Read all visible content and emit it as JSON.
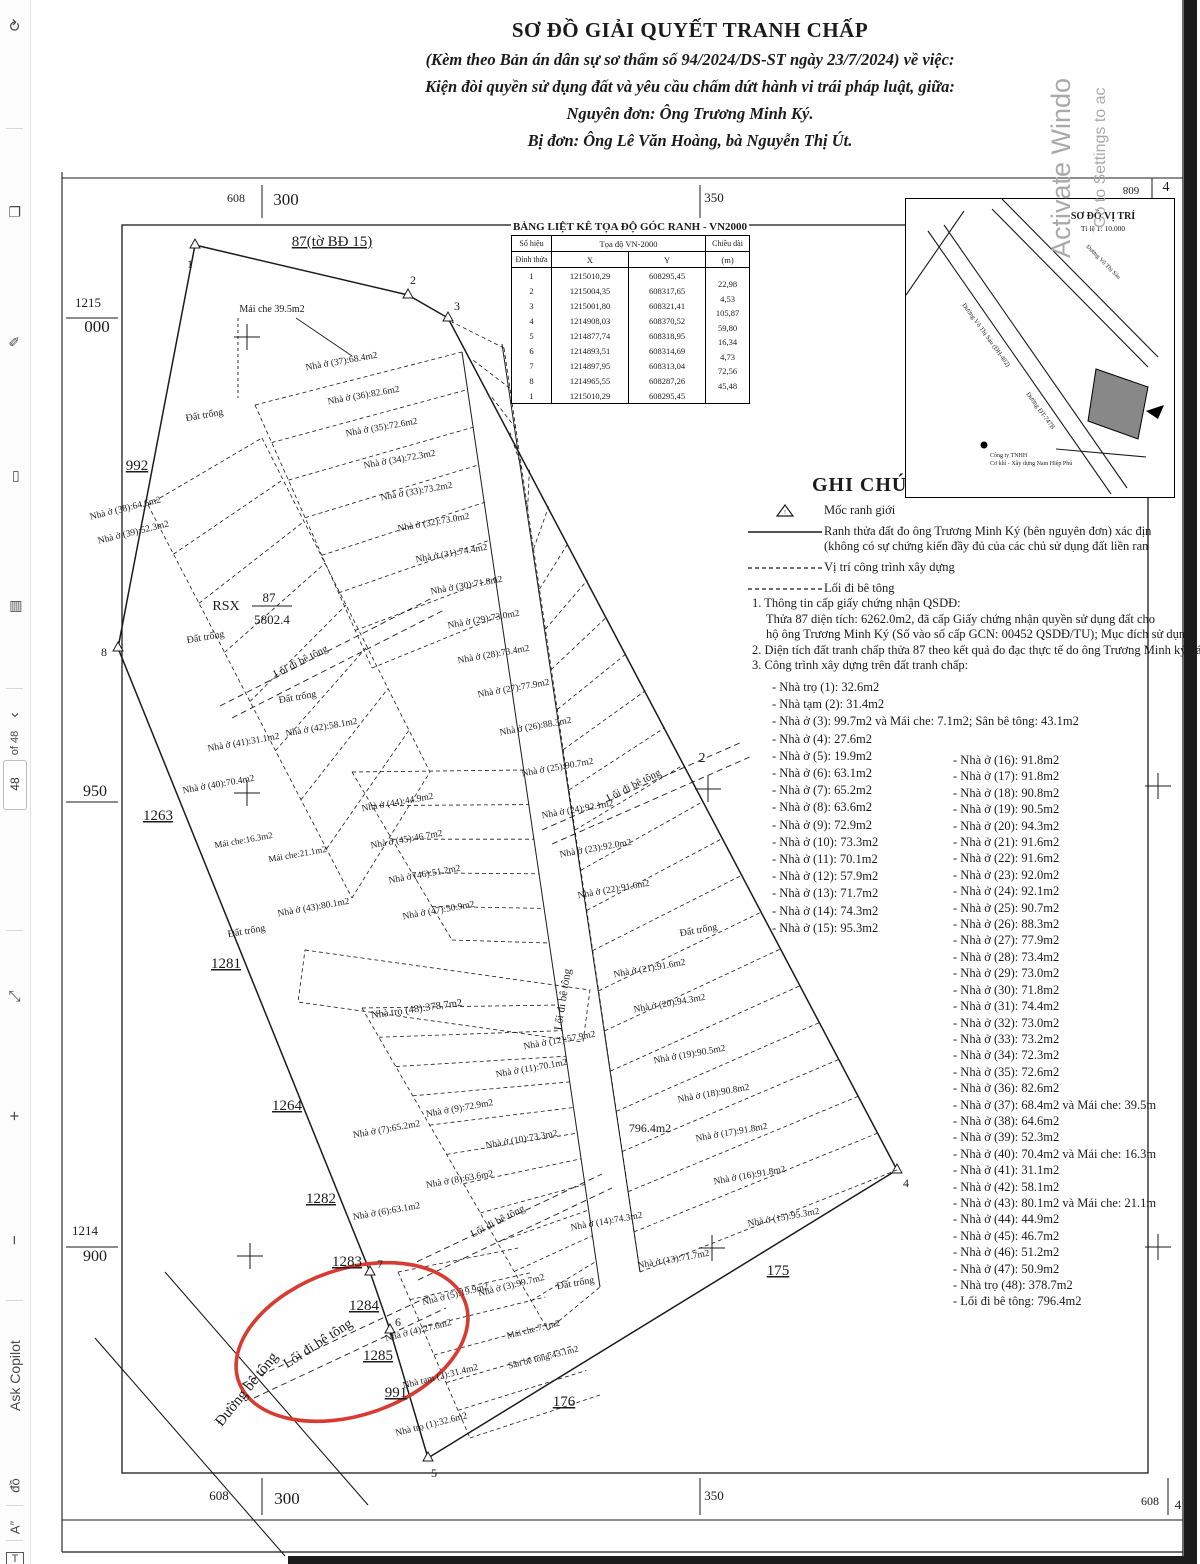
{
  "colors": {
    "ink": "#1b1b1b",
    "red_annotation": "#d93a32",
    "watermark_gray": "#a9a9a9",
    "scan_band": "#1c1c1c"
  },
  "sidebar": {
    "items": [
      {
        "name": "rotate-icon",
        "glyph": "⟳",
        "y": 16,
        "size": 15
      },
      {
        "name": "pages-icon",
        "glyph": "❏",
        "y": 203,
        "size": 14
      },
      {
        "name": "pen-icon",
        "glyph": "✎",
        "y": 333,
        "size": 14
      },
      {
        "name": "highlight-icon",
        "glyph": "▭",
        "y": 468,
        "size": 14
      },
      {
        "name": "print-icon",
        "glyph": "▤",
        "y": 598,
        "size": 14
      },
      {
        "name": "chevron-icon",
        "glyph": "‹",
        "y": 706,
        "size": 16
      },
      {
        "name": "page-count-label",
        "glyph": "of 48",
        "y": 737,
        "size": 11
      },
      {
        "name": "fit-page-icon",
        "glyph": "⤢",
        "y": 988,
        "size": 15
      },
      {
        "name": "zoom-in-icon",
        "glyph": "+",
        "y": 1106,
        "size": 17
      },
      {
        "name": "zoom-out-icon",
        "glyph": "−",
        "y": 1230,
        "size": 17
      },
      {
        "name": "ask-copilot-button",
        "glyph": "Ask Copilot",
        "y": 1388,
        "size": 14
      },
      {
        "name": "translate-icon",
        "glyph": "đồ",
        "y": 1478,
        "size": 13
      },
      {
        "name": "read-aloud-icon",
        "glyph": "A″",
        "y": 1520,
        "size": 13
      },
      {
        "name": "text-box-icon",
        "glyph": "T",
        "y": 1552,
        "size": 11,
        "boxed": true
      }
    ],
    "dividers_y": [
      128,
      688,
      930,
      1300,
      1505,
      1540
    ],
    "page_number": "48"
  },
  "watermark": {
    "line1": "Activate Windo",
    "line2": "Go to Settings to ac"
  },
  "title": {
    "main": "SƠ ĐỒ GIẢI QUYẾT TRANH CHẤP",
    "sub1": "(Kèm theo Bản án dân sự sơ thẩm số 94/2024/DS-ST ngày 23/7/2024) về việc:",
    "sub2": "Kiện đòi quyền sử dụng đất và yêu cầu chấm dứt hành vi trái pháp luật, giữa:",
    "sub3": "Nguyên đơn: Ông Trương Minh Ký.",
    "sub4": "Bị đơn: Ông Lê Văn Hoàng, bà Nguyễn Thị Út."
  },
  "coord_table": {
    "title": "BẢNG LIỆT KÊ TỌA ĐỘ GÓC RANH - VN2000",
    "col1a": "Số hiệu",
    "col1b": "Đỉnh thửa",
    "col2": "Tọa độ VN-2000",
    "colx": "X",
    "coly": "Y",
    "col3a": "Chiều dài",
    "col3b": "(m)",
    "rows": [
      {
        "id": "1",
        "x": "1215010,29",
        "y": "608295,45"
      },
      {
        "id": "2",
        "x": "1215004,35",
        "y": "608317,65"
      },
      {
        "id": "3",
        "x": "1215001,80",
        "y": "608321,41"
      },
      {
        "id": "4",
        "x": "1214908,03",
        "y": "608370,52"
      },
      {
        "id": "5",
        "x": "1214877,74",
        "y": "608318,95"
      },
      {
        "id": "6",
        "x": "1214893,51",
        "y": "608314,69"
      },
      {
        "id": "7",
        "x": "1214897,95",
        "y": "608313,04"
      },
      {
        "id": "8",
        "x": "1214965,55",
        "y": "608287,26"
      },
      {
        "id": "1",
        "x": "1215010,29",
        "y": "608295,45"
      }
    ],
    "lengths": [
      "22,98",
      "4,53",
      "105,87",
      "59,80",
      "16,34",
      "4,73",
      "72,56",
      "45,48"
    ]
  },
  "inset": {
    "title": "SƠ ĐỒ VỊ TRÍ",
    "scale": "Tỉ lệ 1: 10.000",
    "road1": "Đường Võ Thị Sáu (ĐH-402)",
    "road2": "Đường ĐT-747B",
    "road3": "Đường Võ Thị Sáu",
    "poi1": "Công ty TNHH",
    "poi2": "Cơ khí - Xây dựng Nam Hiệp Phú"
  },
  "legend": {
    "heading": "GHI CHÚ",
    "items": [
      {
        "symbol": "triangle",
        "lines": [
          "Mốc ranh giới"
        ]
      },
      {
        "symbol": "solid",
        "lines": [
          "Ranh thửa đất đo ông Trương Minh Ký (bên nguyên đơn) xác địn",
          "(không có sự chứng kiến đầy đủ của các chủ sử dụng đất liền ran"
        ]
      },
      {
        "symbol": "dashed",
        "lines": [
          "Vị trí công trình xây dựng"
        ]
      },
      {
        "symbol": "dashed",
        "lines": [
          "Lối đi bê tông"
        ]
      }
    ]
  },
  "notes": {
    "n1": "1. Thông tin cấp giấy chứng nhận QSDĐ:",
    "n1b": "Thửa 87 diện tích: 6262.0m2, đã cấp Giấy chứng nhận quyền sử dụng đất cho",
    "n1c": "hộ ông Trương Minh Ký (Số vào số cấp GCN: 00452 QSDĐ/TU); Mục đích sử dụn",
    "n2": "2. Diện tích đất tranh chấp thửa 87 theo kết quả đo đạc thực tế do ông Trương Minh ký xác định là: 5",
    "n3": "3. Công trình xây dựng trên đất tranh chấp:"
  },
  "structures": {
    "col1": [
      "- Nhà trọ (1): 32.6m2",
      "- Nhà tạm (2): 31.4m2",
      "- Nhà ở (3): 99.7m2 và Mái che: 7.1m2; Sân bê tông: 43.1m2",
      "- Nhà ở (4): 27.6m2",
      "- Nhà ở (5): 19.9m2",
      "- Nhà ở (6): 63.1m2",
      "- Nhà ở (7): 65.2m2",
      "- Nhà ở (8): 63.6m2",
      "- Nhà ở (9): 72.9m2",
      "- Nhà ở (10): 73.3m2",
      "- Nhà ở (11): 70.1m2",
      "- Nhà ở (12): 57.9m2",
      "- Nhà ở (13): 71.7m2",
      "- Nhà ở (14): 74.3m2",
      "- Nhà ở (15): 95.3m2"
    ],
    "col2": [
      "- Nhà ở (16): 91.8m2",
      "- Nhà ở (17): 91.8m2",
      "- Nhà ở (18): 90.8m2",
      "- Nhà ở (19): 90.5m2",
      "- Nhà ở (20): 94.3m2",
      "- Nhà ở (21): 91.6m2",
      "- Nhà ở (22): 91.6m2",
      "- Nhà ở (23): 92.0m2",
      "- Nhà ở (24): 92.1m2",
      "- Nhà ở (25): 90.7m2",
      "- Nhà ở (26): 88.3m2",
      "- Nhà ở (27): 77.9m2",
      "- Nhà ở (28): 73.4m2",
      "- Nhà ở (29): 73.0m2",
      "- Nhà ở (30): 71.8m2",
      "- Nhà ở (31): 74.4m2",
      "- Nhà ở (32): 73.0m2",
      "- Nhà ở (33): 73.2m2",
      "- Nhà ở (34): 72.3m2",
      "- Nhà ở (35): 72.6m2",
      "- Nhà ở (36): 82.6m2",
      "- Nhà ở (37): 68.4m2 và Mái che: 39.5m",
      "- Nhà ở (38): 64.6m2",
      "- Nhà ở (39): 52.3m2",
      "- Nhà ở (40): 70.4m2 và Mái che: 16.3m",
      "- Nhà ở (41): 31.1m2",
      "- Nhà ở (42): 58.1m2",
      "- Nhà ở (43): 80.1m2 và Mái che: 21.1m",
      "- Nhà ở (44): 44.9m2",
      "- Nhà ở (45): 46.7m2",
      "- Nhà ở (46): 51.2m2",
      "- Nhà ở (47): 50.9m2",
      "- Nhà trọ (48): 378.7m2",
      "- Lối đi bê tông: 796.4m2"
    ]
  },
  "map": {
    "grid_labels": [
      [
        "608",
        236,
        202,
        12,
        0
      ],
      [
        "300",
        286,
        205,
        17,
        0
      ],
      [
        "350",
        714,
        202,
        13,
        0
      ],
      [
        "608",
        1131,
        187,
        11,
        180
      ],
      [
        "4",
        1166,
        191,
        14,
        0
      ],
      [
        "1215",
        88,
        307,
        13,
        0
      ],
      [
        "000",
        97,
        332,
        17,
        0
      ],
      [
        "950",
        95,
        796,
        16,
        0
      ],
      [
        "1214",
        85,
        1235,
        13,
        0
      ],
      [
        "900",
        95,
        1261,
        16,
        0
      ],
      [
        "608",
        219,
        1500,
        13,
        0
      ],
      [
        "300",
        287,
        1504,
        17,
        0
      ],
      [
        "350",
        714,
        1500,
        13,
        0
      ],
      [
        "608",
        1150,
        1505,
        12,
        0
      ],
      [
        "4",
        1178,
        1509,
        13,
        0
      ]
    ],
    "labels": [
      [
        "87(tờ BĐ 15)",
        332,
        246,
        0,
        15,
        1
      ],
      [
        "RSX",
        226,
        610,
        0,
        14,
        0
      ],
      [
        "87",
        269,
        602,
        0,
        13,
        0
      ],
      [
        "5802.4",
        272,
        624,
        0,
        13,
        0
      ],
      [
        "992",
        137,
        470,
        0,
        15,
        1
      ],
      [
        "1263",
        158,
        820,
        0,
        15,
        1
      ],
      [
        "1281",
        226,
        968,
        0,
        15,
        1
      ],
      [
        "1264",
        287,
        1110,
        0,
        15,
        1
      ],
      [
        "1282",
        321,
        1203,
        0,
        15,
        1
      ],
      [
        "1283",
        347,
        1266,
        0,
        15,
        1
      ],
      [
        "1284",
        364,
        1310,
        0,
        15,
        1
      ],
      [
        "1285",
        378,
        1360,
        0,
        15,
        1
      ],
      [
        "991",
        396,
        1397,
        0,
        15,
        1
      ],
      [
        "176",
        564,
        1406,
        0,
        15,
        1
      ],
      [
        "175",
        778,
        1275,
        0,
        15,
        1
      ],
      [
        "2",
        702,
        762,
        0,
        14,
        0
      ],
      [
        "1",
        190,
        268,
        0,
        12,
        0
      ],
      [
        "2",
        413,
        284,
        0,
        12,
        0
      ],
      [
        "3",
        457,
        310,
        0,
        12,
        0
      ],
      [
        "4",
        906,
        1187,
        0,
        12,
        0
      ],
      [
        "5",
        434,
        1477,
        0,
        12,
        0
      ],
      [
        "6",
        398,
        1326,
        0,
        12,
        0
      ],
      [
        "7",
        380,
        1268,
        0,
        12,
        0
      ],
      [
        "8",
        104,
        656,
        0,
        12,
        0
      ],
      [
        "Đất trống",
        205,
        418,
        -10,
        10,
        0
      ],
      [
        "Đất trống",
        206,
        640,
        -10,
        10,
        0
      ],
      [
        "Đất trống",
        298,
        700,
        -10,
        10,
        0
      ],
      [
        "Đất trống",
        247,
        934,
        -10,
        10,
        0
      ],
      [
        "Đất trống",
        699,
        933,
        -10,
        10,
        0
      ],
      [
        "Đất trống",
        576,
        1286,
        -10,
        10,
        0
      ],
      [
        "Mái che 39.5m2",
        272,
        312,
        0,
        10,
        0
      ],
      [
        "Nhà ở (37):68.4m2",
        342,
        364,
        -10,
        9.5,
        0
      ],
      [
        "Nhà ở (36):82.6m2",
        364,
        398,
        -10,
        9.5,
        0
      ],
      [
        "Nhà ở (35):72.6m2",
        382,
        430,
        -10,
        9.5,
        0
      ],
      [
        "Nhà ở (34):72.3m2",
        400,
        462,
        -10,
        9.5,
        0
      ],
      [
        "Nhà ở (33):73.2m2",
        417,
        494,
        -10,
        9.5,
        0
      ],
      [
        "Nhà ở (32):73.0m2",
        434,
        525,
        -10,
        9.5,
        0
      ],
      [
        "Nhà ở (31):74.4m2",
        452,
        556,
        -10,
        9.5,
        0
      ],
      [
        "Nhà ở (30):71.8m2",
        467,
        588,
        -10,
        9.5,
        0
      ],
      [
        "Nhà ở (29):73.0m2",
        484,
        622,
        -10,
        9.5,
        0
      ],
      [
        "Nhà ở (28):73.4m2",
        494,
        657,
        -10,
        9.5,
        0
      ],
      [
        "Nhà ở (27):77.9m2",
        514,
        691,
        -10,
        9.5,
        0
      ],
      [
        "Nhà ở (26):88.3m2",
        536,
        729,
        -10,
        9.5,
        0
      ],
      [
        "Nhà ở (25):90.7m2",
        558,
        770,
        -10,
        9.5,
        0
      ],
      [
        "Nhà ở (24):92.1m2",
        578,
        812,
        -10,
        9.5,
        0
      ],
      [
        "Nhà ở (23):92.0m2",
        596,
        851,
        -10,
        9.5,
        0
      ],
      [
        "Nhà ở (22):91.6m2",
        614,
        892,
        -10,
        9.5,
        0
      ],
      [
        "Nhà ở (21):91.6m2",
        650,
        971,
        -10,
        9.5,
        0
      ],
      [
        "Nhà ở (20):94.3m2",
        670,
        1006,
        -10,
        9.5,
        0
      ],
      [
        "Nhà ở (19):90.5m2",
        690,
        1057,
        -10,
        9.5,
        0
      ],
      [
        "Nhà ở (18):90.8m2",
        714,
        1096,
        -10,
        9.5,
        0
      ],
      [
        "Nhà ở (17):91.8m2",
        732,
        1135,
        -10,
        9.5,
        0
      ],
      [
        "Nhà ở (16):91.8m2",
        750,
        1178,
        -10,
        9.5,
        0
      ],
      [
        "Nhà ở (15):95.3m2",
        784,
        1220,
        -10,
        9.5,
        0
      ],
      [
        "Nhà ở (38):64.6m2",
        126,
        511,
        -14,
        9.5,
        0
      ],
      [
        "Nhà ở (39):52.3m2",
        134,
        535,
        -14,
        9.5,
        0
      ],
      [
        "Nhà ở (41):31.1m2",
        244,
        745,
        -10,
        9.5,
        0
      ],
      [
        "Nhà ở (42):58.1m2",
        322,
        730,
        -10,
        9.5,
        0
      ],
      [
        "Nhà ở (40):70.4m2",
        219,
        787,
        -10,
        9.5,
        0
      ],
      [
        "Mái che:16.3m2",
        244,
        843,
        -10,
        9,
        0
      ],
      [
        "Mái che:21.1m2",
        298,
        857,
        -10,
        9,
        0
      ],
      [
        "Nhà ở (44):44.9m2",
        398,
        805,
        -10,
        9.5,
        0
      ],
      [
        "Nhà ở (45):46.7m2",
        407,
        842,
        -10,
        9.5,
        0
      ],
      [
        "Nhà ở (46):51.2m2",
        425,
        877,
        -10,
        9.5,
        0
      ],
      [
        "Nhà ở (43):80.1m2",
        314,
        910,
        -10,
        9.5,
        0
      ],
      [
        "Nhà ở (47):50.9m2",
        439,
        913,
        -10,
        9.5,
        0
      ],
      [
        "Nhà trọ (48):378.7m2",
        417,
        1012,
        -8,
        10.5,
        0
      ],
      [
        "Nhà ở (11):70.1m2",
        532,
        1071,
        -10,
        9.5,
        0
      ],
      [
        "Nhà ở (12):57.9m2",
        560,
        1043,
        -10,
        9.5,
        0
      ],
      [
        "Nhà ở (9):72.9m2",
        460,
        1111,
        -10,
        9.5,
        0
      ],
      [
        "Nhà ở (7):65.2m2",
        387,
        1132,
        -10,
        9.5,
        0
      ],
      [
        "Nhà ở (10):73.3m2",
        522,
        1142,
        -10,
        9.5,
        0
      ],
      [
        "Nhà ở (8):63.6m2",
        460,
        1182,
        -10,
        9.5,
        0
      ],
      [
        "Nhà ở (6):63.1m2",
        387,
        1214,
        -10,
        9.5,
        0
      ],
      [
        "Nhà ở (14):74.3m2",
        607,
        1224,
        -10,
        9.5,
        0
      ],
      [
        "Nhà ở (13):71.7m2",
        674,
        1262,
        -10,
        9.5,
        0
      ],
      [
        "Nhà ở (3):99.7m2",
        512,
        1288,
        -14,
        9.5,
        0
      ],
      [
        "Nhà ở (5):19.9m2",
        456,
        1297,
        -14,
        9.5,
        0
      ],
      [
        "Nhà ở (4):27.6m2",
        419,
        1333,
        -14,
        9.5,
        0
      ],
      [
        "Mái che:7.1m2",
        534,
        1332,
        -14,
        9,
        0
      ],
      [
        "Sân bê tông:43.1m2",
        544,
        1360,
        -14,
        9,
        0
      ],
      [
        "Nhà tạm (2):31.4m2",
        441,
        1379,
        -14,
        9.5,
        0
      ],
      [
        "Nhà trọ (1):32.6m2",
        432,
        1427,
        -14,
        9.5,
        0
      ],
      [
        "Lối đi bê tông",
        302,
        664,
        -27,
        10.5,
        0
      ],
      [
        "Lối đi bê tông",
        635,
        788,
        -27,
        10.5,
        0
      ],
      [
        "Lối đi bê tông",
        566,
        1000,
        -81,
        11,
        0
      ],
      [
        "Lối đi bê tông",
        499,
        1224,
        -27,
        10.5,
        0
      ],
      [
        "Lối đi bê tông",
        320,
        1347,
        -33,
        14,
        0
      ],
      [
        "796.4m2",
        650,
        1132,
        0,
        12,
        0
      ],
      [
        "Đường bê tông",
        250,
        1392,
        -51,
        15,
        0
      ]
    ]
  }
}
